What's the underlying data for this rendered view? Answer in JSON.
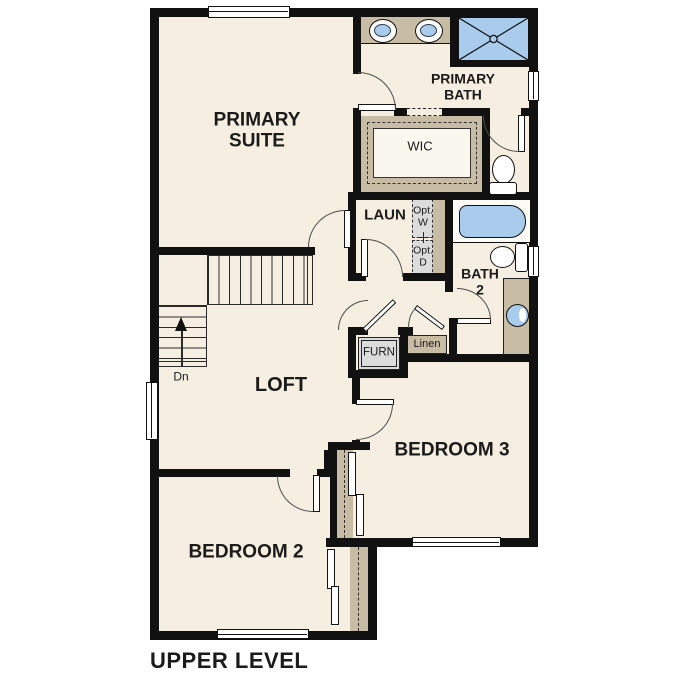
{
  "plan_title": "UPPER LEVEL",
  "labels": {
    "primary_suite": "PRIMARY SUITE",
    "primary_bath": "PRIMARY BATH",
    "wic": "WIC",
    "laundry": "LAUN",
    "opt_washer": "Opt. W",
    "opt_dryer": "Opt. D",
    "bath2": "BATH 2",
    "furnace": "FURN",
    "linen": "Linen",
    "loft": "LOFT",
    "bedroom2": "BEDROOM 2",
    "bedroom3": "BEDROOM 3",
    "stairs_down": "Dn"
  },
  "colors": {
    "background": "#ffffff",
    "floor": "#f5eee1",
    "wall": "#111111",
    "fixture_blue": "#a9cbec",
    "cabinet_tan": "#c8bca4",
    "appliance_gray": "#dcdcdc",
    "text": "#1b1b1b"
  }
}
